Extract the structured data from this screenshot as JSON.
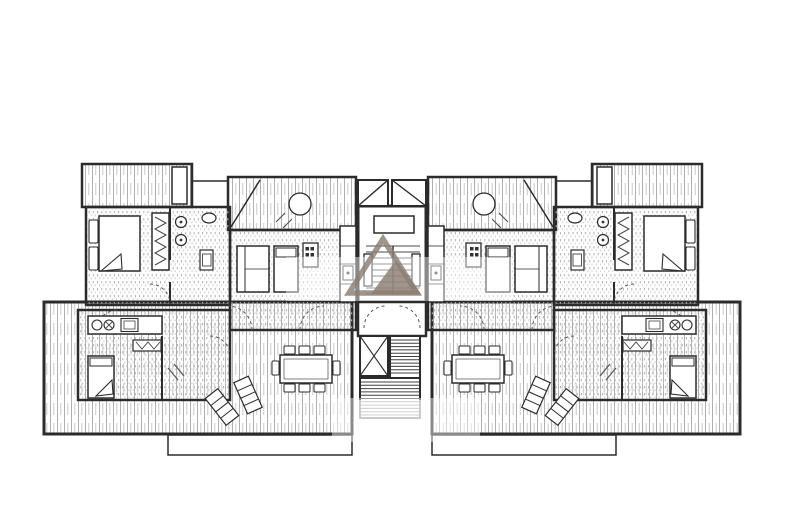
{
  "canvas": {
    "width": 800,
    "height": 531,
    "background": "#ffffff",
    "mirror_axis_x": 392
  },
  "palette": {
    "wall": "#2b2b2b",
    "furniture_stroke": "#3a3a3a",
    "hatch_dark": "#a6a6a6",
    "hatch_light": "#c4c4c4",
    "dot_dark": "#b0b0b0",
    "dot_light": "#c9c9c9",
    "tread": "#4a4a4a",
    "swing": "#555555",
    "watermark": "#8b7e73",
    "paper": "#ffffff"
  },
  "drawing": {
    "type": "architectural-floor-plan",
    "description": "Symmetric apartment floor plan: two mirrored wings around a central stair core with skylights, elevator shaft and descending stairs; terraces with furniture; gray triangle logo watermark"
  },
  "left_wing": [
    {
      "n": "terrace-lower",
      "t": "rect",
      "x": 44,
      "y": 302,
      "w": 308,
      "h": 132,
      "f": "v",
      "sw": 3
    },
    {
      "n": "terrace-lower-lip",
      "t": "rect",
      "x": 168,
      "y": 435,
      "w": 184,
      "h": 20,
      "f": "w",
      "sw": 1.5
    },
    {
      "n": "balcony-top",
      "t": "rect",
      "x": 82,
      "y": 164,
      "w": 110,
      "h": 43,
      "f": "v",
      "sw": 2.5
    },
    {
      "n": "balcony-planter",
      "t": "rect",
      "x": 172,
      "y": 167,
      "w": 15,
      "h": 37,
      "f": "w",
      "sw": 1.5
    },
    {
      "n": "parapet-link",
      "t": "line",
      "x1": 192,
      "y1": 181,
      "x2": 228,
      "y2": 181,
      "sw": 1.5
    },
    {
      "n": "terrace-mid",
      "t": "rect",
      "x": 228,
      "y": 177,
      "w": 128,
      "h": 53,
      "f": "v",
      "sw": 2.5
    },
    {
      "n": "terrace-mid-brace",
      "t": "line",
      "x1": 231,
      "y1": 227,
      "x2": 260,
      "y2": 180,
      "sw": 1.5
    },
    {
      "n": "terrace-round-table",
      "t": "circle",
      "cx": 300,
      "cy": 204,
      "r": 11,
      "f": "w",
      "sw": 1.3
    },
    {
      "n": "terrace-chair-mark",
      "t": "line",
      "x1": 276,
      "y1": 222,
      "x2": 285,
      "y2": 213,
      "sw": 1.2,
      "sc": "#555555"
    },
    {
      "n": "terrace-chair-mark",
      "t": "line",
      "x1": 283,
      "y1": 228,
      "x2": 292,
      "y2": 219,
      "sw": 1.2,
      "sc": "#555555"
    },
    {
      "n": "bedroom-upper",
      "t": "rect",
      "x": 86,
      "y": 207,
      "w": 144,
      "h": 98,
      "f": "d",
      "sw": 2.5
    },
    {
      "n": "living-upper",
      "t": "rect",
      "x": 230,
      "y": 230,
      "w": 126,
      "h": 100,
      "f": "d",
      "sw": 2.5
    },
    {
      "n": "suite-lower",
      "t": "rect",
      "x": 78,
      "y": 310,
      "w": 152,
      "h": 90,
      "f": "d",
      "sw": 2.5
    },
    {
      "n": "wall-bathroom",
      "t": "line",
      "x1": 170,
      "y1": 207,
      "x2": 170,
      "y2": 260,
      "sw": 2
    },
    {
      "n": "wall-bathroom",
      "t": "line",
      "x1": 170,
      "y1": 282,
      "x2": 170,
      "y2": 305,
      "sw": 2
    },
    {
      "n": "wall-suite-divider",
      "t": "line",
      "x1": 162,
      "y1": 336,
      "x2": 162,
      "y2": 400,
      "sw": 2
    },
    {
      "n": "wardrobe-upper",
      "t": "rect",
      "x": 152,
      "y": 213,
      "w": 17,
      "h": 57,
      "f": "w",
      "sw": 1.5
    },
    {
      "n": "wardrobe-rail",
      "t": "path",
      "d": "M155,217 L166,223 L155,229 L166,235 L155,241 L166,247 L155,253 L166,259 L155,265",
      "f": "none",
      "sw": 1,
      "sc": "#444444"
    },
    {
      "n": "bed-pillow",
      "t": "rect",
      "x": 89,
      "y": 220,
      "w": 9,
      "h": 23,
      "f": "w",
      "sw": 1.1,
      "rx": 1.5
    },
    {
      "n": "bed-pillow",
      "t": "rect",
      "x": 89,
      "y": 247,
      "w": 9,
      "h": 23,
      "f": "w",
      "sw": 1.1,
      "rx": 1.5
    },
    {
      "n": "bed-double",
      "t": "rect",
      "x": 99,
      "y": 216,
      "w": 41,
      "h": 55,
      "f": "w",
      "sw": 1.5
    },
    {
      "n": "bed-fold",
      "t": "poly",
      "p": "121,254 101,271 122,269",
      "f": "w",
      "sw": 1.1
    },
    {
      "n": "toilet",
      "t": "circle",
      "cx": 181,
      "cy": 222,
      "r": 5.5,
      "f": "w",
      "sw": 1.2
    },
    {
      "n": "toilet-dot",
      "t": "circle",
      "cx": 181,
      "cy": 222,
      "r": 1.4,
      "f": "#333333",
      "sw": 0
    },
    {
      "n": "bidet",
      "t": "circle",
      "cx": 181,
      "cy": 240,
      "r": 5.5,
      "f": "w",
      "sw": 1.2
    },
    {
      "n": "bidet-dot",
      "t": "circle",
      "cx": 181,
      "cy": 240,
      "r": 1.4,
      "f": "#333333",
      "sw": 0
    },
    {
      "n": "washbasin",
      "t": "ellipse",
      "cx": 209,
      "cy": 218,
      "rx": 7,
      "ry": 5,
      "f": "w",
      "sw": 1.2
    },
    {
      "n": "shower-tray",
      "t": "rect",
      "x": 200,
      "y": 250,
      "w": 13,
      "h": 20,
      "f": "w",
      "sw": 1.2
    },
    {
      "n": "shower-tray-inner",
      "t": "rect",
      "x": 202.5,
      "y": 254,
      "w": 8.5,
      "h": 12,
      "f": "none",
      "sw": 0.8
    },
    {
      "n": "door-swing",
      "t": "path",
      "d": "M150,284 A20,20 0 0 1 170,304",
      "f": "none",
      "da": "3,3",
      "sw": 1,
      "sc": "#555555"
    },
    {
      "n": "door-swing",
      "t": "path",
      "d": "M252,330 A24,24 0 0 0 228,306",
      "f": "none",
      "da": "3,3",
      "sw": 1,
      "sc": "#555555"
    },
    {
      "n": "door-swing",
      "t": "path",
      "d": "M300,330 A24,24 0 0 1 324,306",
      "f": "none",
      "da": "3,3",
      "sw": 1,
      "sc": "#555555"
    },
    {
      "n": "door-swing",
      "t": "path",
      "d": "M96,332 A22,22 0 0 1 118,310",
      "f": "none",
      "da": "3,3",
      "sw": 1,
      "sc": "#555555"
    },
    {
      "n": "door-swing",
      "t": "path",
      "d": "M210,336 A20,20 0 0 1 230,356",
      "f": "none",
      "da": "3,3",
      "sw": 1,
      "sc": "#555555"
    },
    {
      "n": "sofa",
      "t": "rect",
      "x": 237,
      "y": 246,
      "w": 32,
      "h": 46,
      "f": "w",
      "sw": 1.5
    },
    {
      "n": "sofa-back",
      "t": "line",
      "x1": 245,
      "y1": 246,
      "x2": 245,
      "y2": 292,
      "sw": 1
    },
    {
      "n": "sofa-cushion",
      "t": "line",
      "x1": 245,
      "y1": 269,
      "x2": 269,
      "y2": 269,
      "sw": 0.8
    },
    {
      "n": "daybed",
      "t": "rect",
      "x": 274,
      "y": 246,
      "w": 24,
      "h": 46,
      "f": "w",
      "sw": 1.5
    },
    {
      "n": "daybed-pillow",
      "t": "rect",
      "x": 276,
      "y": 248,
      "w": 20,
      "h": 9,
      "f": "w",
      "sw": 1
    },
    {
      "n": "kitchen-block",
      "t": "rect",
      "x": 303,
      "y": 243,
      "w": 15,
      "h": 24,
      "f": "w",
      "sw": 1.3
    },
    {
      "n": "burner",
      "t": "rect",
      "x": 305.5,
      "y": 247,
      "w": 3.5,
      "h": 3.5,
      "f": "#333333",
      "sw": 0
    },
    {
      "n": "burner",
      "t": "rect",
      "x": 310.5,
      "y": 247,
      "w": 3.5,
      "h": 3.5,
      "f": "#333333",
      "sw": 0
    },
    {
      "n": "burner",
      "t": "rect",
      "x": 305.5,
      "y": 253,
      "w": 3.5,
      "h": 3.5,
      "f": "#333333",
      "sw": 0
    },
    {
      "n": "burner",
      "t": "rect",
      "x": 310.5,
      "y": 253,
      "w": 3.5,
      "h": 3.5,
      "f": "#333333",
      "sw": 0
    },
    {
      "n": "kitchen-counter",
      "t": "rect",
      "x": 340,
      "y": 226,
      "w": 16,
      "h": 76,
      "f": "w",
      "sw": 1.5
    },
    {
      "n": "counter-divider",
      "t": "line",
      "x1": 340,
      "y1": 246,
      "x2": 356,
      "y2": 246,
      "sw": 0.8
    },
    {
      "n": "counter-divider",
      "t": "line",
      "x1": 340,
      "y1": 264,
      "x2": 356,
      "y2": 264,
      "sw": 0.8
    },
    {
      "n": "counter-divider",
      "t": "line",
      "x1": 340,
      "y1": 284,
      "x2": 356,
      "y2": 284,
      "sw": 0.8
    },
    {
      "n": "counter-appliance",
      "t": "rect",
      "x": 343,
      "y": 266,
      "w": 10,
      "h": 14,
      "f": "none",
      "sw": 1
    },
    {
      "n": "appliance-dot",
      "t": "circle",
      "cx": 348,
      "cy": 273,
      "r": 1.5,
      "f": "#333333",
      "sw": 0
    },
    {
      "n": "dining-table",
      "t": "rect",
      "x": 280,
      "y": 355,
      "w": 52,
      "h": 28,
      "f": "w",
      "sw": 1.5
    },
    {
      "n": "dining-table-inner",
      "t": "rect",
      "x": 284,
      "y": 359,
      "w": 44,
      "h": 20,
      "f": "none",
      "sw": 0.6
    },
    {
      "n": "dining-chair",
      "t": "rect",
      "x": 284,
      "y": 346,
      "w": 11,
      "h": 8,
      "f": "w",
      "sw": 1,
      "rx": 1
    },
    {
      "n": "dining-chair",
      "t": "rect",
      "x": 299,
      "y": 346,
      "w": 11,
      "h": 8,
      "f": "w",
      "sw": 1,
      "rx": 1
    },
    {
      "n": "dining-chair",
      "t": "rect",
      "x": 314,
      "y": 346,
      "w": 11,
      "h": 8,
      "f": "w",
      "sw": 1,
      "rx": 1
    },
    {
      "n": "dining-chair",
      "t": "rect",
      "x": 284,
      "y": 384,
      "w": 11,
      "h": 8,
      "f": "w",
      "sw": 1,
      "rx": 1
    },
    {
      "n": "dining-chair",
      "t": "rect",
      "x": 299,
      "y": 384,
      "w": 11,
      "h": 8,
      "f": "w",
      "sw": 1,
      "rx": 1
    },
    {
      "n": "dining-chair",
      "t": "rect",
      "x": 314,
      "y": 384,
      "w": 11,
      "h": 8,
      "f": "w",
      "sw": 1,
      "rx": 1
    },
    {
      "n": "dining-chair",
      "t": "rect",
      "x": 272,
      "y": 361,
      "w": 7,
      "h": 14,
      "f": "w",
      "sw": 1,
      "rx": 1
    },
    {
      "n": "dining-chair",
      "t": "rect",
      "x": 333,
      "y": 361,
      "w": 7,
      "h": 14,
      "f": "w",
      "sw": 1,
      "rx": 1
    },
    {
      "n": "lounge-chair",
      "t": "rect",
      "x": 214,
      "y": 390,
      "w": 16,
      "h": 34,
      "f": "w",
      "sw": 1.2,
      "tr": "rotate(-38 222 407)"
    },
    {
      "n": "lounge-stripe",
      "t": "line",
      "x1": 214,
      "y1": 399,
      "x2": 230,
      "y2": 399,
      "sw": 1,
      "tr": "rotate(-38 222 407)"
    },
    {
      "n": "lounge-stripe",
      "t": "line",
      "x1": 214,
      "y1": 407,
      "x2": 230,
      "y2": 407,
      "sw": 1,
      "tr": "rotate(-38 222 407)"
    },
    {
      "n": "lounge-stripe",
      "t": "line",
      "x1": 214,
      "y1": 415,
      "x2": 230,
      "y2": 415,
      "sw": 1,
      "tr": "rotate(-38 222 407)"
    },
    {
      "n": "lounge-chair",
      "t": "rect",
      "x": 240,
      "y": 378,
      "w": 16,
      "h": 34,
      "f": "w",
      "sw": 1.2,
      "tr": "rotate(-24 248 395)"
    },
    {
      "n": "lounge-stripe",
      "t": "line",
      "x1": 240,
      "y1": 387,
      "x2": 256,
      "y2": 387,
      "sw": 1,
      "tr": "rotate(-24 248 395)"
    },
    {
      "n": "lounge-stripe",
      "t": "line",
      "x1": 240,
      "y1": 395,
      "x2": 256,
      "y2": 395,
      "sw": 1,
      "tr": "rotate(-24 248 395)"
    },
    {
      "n": "lounge-stripe",
      "t": "line",
      "x1": 240,
      "y1": 403,
      "x2": 256,
      "y2": 403,
      "sw": 1,
      "tr": "rotate(-24 248 395)"
    },
    {
      "n": "kitchenette-lower",
      "t": "rect",
      "x": 88,
      "y": 316,
      "w": 74,
      "h": 18,
      "f": "w",
      "sw": 1.5
    },
    {
      "n": "sink-round",
      "t": "circle",
      "cx": 97,
      "cy": 325,
      "r": 5,
      "f": "w",
      "sw": 1.1
    },
    {
      "n": "hob-round",
      "t": "circle",
      "cx": 109,
      "cy": 325,
      "r": 5,
      "f": "w",
      "sw": 1.1
    },
    {
      "n": "hob-cross",
      "t": "line",
      "x1": 106,
      "y1": 322,
      "x2": 112,
      "y2": 328,
      "sw": 0.9,
      "sc": "#444444"
    },
    {
      "n": "hob-cross",
      "t": "line",
      "x1": 112,
      "y1": 322,
      "x2": 106,
      "y2": 328,
      "sw": 0.9,
      "sc": "#444444"
    },
    {
      "n": "stove-lower",
      "t": "rect",
      "x": 121,
      "y": 318.5,
      "w": 17,
      "h": 13,
      "f": "w",
      "sw": 1.1
    },
    {
      "n": "stove-inner",
      "t": "rect",
      "x": 124,
      "y": 321,
      "w": 11,
      "h": 8,
      "f": "none",
      "sw": 0.7
    },
    {
      "n": "wardrobe-lower",
      "t": "rect",
      "x": 133,
      "y": 340,
      "w": 28,
      "h": 11,
      "f": "w",
      "sw": 1.2
    },
    {
      "n": "wardrobe-rail",
      "t": "path",
      "d": "M136,342 L142,349 L148,342 L154,349 L160,342",
      "f": "none",
      "sw": 0.9,
      "sc": "#444444"
    },
    {
      "n": "bed-single",
      "t": "rect",
      "x": 88,
      "y": 356,
      "w": 26,
      "h": 42,
      "f": "w",
      "sw": 1.5
    },
    {
      "n": "bed-pillow",
      "t": "rect",
      "x": 90,
      "y": 358,
      "w": 22,
      "h": 8,
      "f": "w",
      "sw": 1
    },
    {
      "n": "bed-fold",
      "t": "poly",
      "p": "112,380 96,396 113,394",
      "f": "w",
      "sw": 1.1
    },
    {
      "n": "chair-mark",
      "t": "line",
      "x1": 168,
      "y1": 368,
      "x2": 178,
      "y2": 380,
      "sw": 1.2,
      "sc": "#555555"
    },
    {
      "n": "chair-mark",
      "t": "line",
      "x1": 174,
      "y1": 364,
      "x2": 184,
      "y2": 376,
      "sw": 1.2,
      "sc": "#555555"
    }
  ],
  "center_core": [
    {
      "n": "stair-core",
      "t": "rect",
      "x": 358,
      "y": 206,
      "w": 68,
      "h": 96,
      "f": "w",
      "sw": 3
    },
    {
      "n": "skylight",
      "t": "rect",
      "x": 358,
      "y": 180,
      "w": 30,
      "h": 26,
      "f": "w",
      "sw": 2
    },
    {
      "n": "skylight-diagonal",
      "t": "line",
      "x1": 358,
      "y1": 206,
      "x2": 388,
      "y2": 180,
      "sw": 1.4
    },
    {
      "n": "skylight",
      "t": "rect",
      "x": 392,
      "y": 180,
      "w": 34,
      "h": 26,
      "f": "w",
      "sw": 2
    },
    {
      "n": "skylight-diagonal",
      "t": "line",
      "x1": 392,
      "y1": 180,
      "x2": 426,
      "y2": 206,
      "sw": 1.4
    },
    {
      "n": "stair-landing",
      "t": "rect",
      "x": 374,
      "y": 216,
      "w": 40,
      "h": 17,
      "f": "none",
      "sw": 1.5
    },
    {
      "n": "stair-treads",
      "t": "hlines",
      "x": 366,
      "w": 54,
      "y0": 246,
      "dy": 6,
      "cnt": 9,
      "sw": 1.1,
      "sc": "#4a4a4a"
    },
    {
      "n": "stair-divider",
      "t": "line",
      "x1": 393,
      "y1": 246,
      "x2": 393,
      "y2": 295,
      "sw": 1.4
    },
    {
      "n": "stair-rail",
      "t": "rect",
      "x": 364,
      "y": 254,
      "w": 8,
      "h": 32,
      "f": "w",
      "sw": 1.3
    },
    {
      "n": "stair-rail",
      "t": "rect",
      "x": 412,
      "y": 254,
      "w": 8,
      "h": 32,
      "f": "w",
      "sw": 1.3
    },
    {
      "n": "stair-lobby",
      "t": "rect",
      "x": 358,
      "y": 302,
      "w": 68,
      "h": 34,
      "f": "w",
      "sw": 2.5
    },
    {
      "n": "door-swing",
      "t": "path",
      "d": "M364,328 A22,22 0 0 1 386,306",
      "f": "none",
      "da": "3,3",
      "sw": 1,
      "sc": "#555555"
    },
    {
      "n": "door-swing",
      "t": "path",
      "d": "M420,328 A22,22 0 0 0 398,306",
      "f": "none",
      "da": "3,3",
      "sw": 1,
      "sc": "#555555"
    },
    {
      "n": "elevator-shaft",
      "t": "rect",
      "x": 360,
      "y": 336,
      "w": 28,
      "h": 40,
      "f": "w",
      "sw": 2
    },
    {
      "n": "elevator-x",
      "t": "line",
      "x1": 360,
      "y1": 336,
      "x2": 388,
      "y2": 376,
      "sw": 1.1
    },
    {
      "n": "elevator-x",
      "t": "line",
      "x1": 388,
      "y1": 336,
      "x2": 360,
      "y2": 376,
      "sw": 1.1
    },
    {
      "n": "stair-down-upper",
      "t": "rect",
      "x": 390,
      "y": 336,
      "w": 30,
      "h": 42,
      "f": "w",
      "sw": 2
    },
    {
      "n": "stair-down-treads",
      "t": "hlines",
      "x": 391,
      "w": 28,
      "y0": 340,
      "dy": 3.3,
      "cnt": 11,
      "sw": 1,
      "sc": "#3f3f3f"
    },
    {
      "n": "stair-down-lower",
      "t": "rect",
      "x": 360,
      "y": 378,
      "w": 60,
      "h": 40,
      "f": "w",
      "sw": 2
    },
    {
      "n": "stair-down-treads",
      "t": "hlines",
      "x": 361,
      "w": 58,
      "y0": 382,
      "dy": 3.3,
      "cnt": 11,
      "sw": 1,
      "sc": "#3f3f3f"
    },
    {
      "n": "print-fade",
      "t": "rect",
      "x": 356,
      "y": 400,
      "w": 68,
      "h": 24,
      "f": "#ffffff",
      "sw": 0,
      "op": 0.55
    },
    {
      "n": "watermark-band",
      "t": "rect",
      "x": 286,
      "y": 257,
      "w": 226,
      "h": 44,
      "f": "#ffffff",
      "sw": 0,
      "op": 0.45
    },
    {
      "n": "watermark-band",
      "t": "rect",
      "x": 332,
      "y": 398,
      "w": 148,
      "h": 44,
      "f": "#ffffff",
      "sw": 0,
      "op": 0.45
    },
    {
      "n": "watermark-triangle-outline",
      "t": "path",
      "d": "M383,239 L417,293 L349,293 Z",
      "f": "none",
      "sw": 5.5,
      "sc": "#8b7e73",
      "op": 0.82
    },
    {
      "n": "watermark-triangle-solid",
      "t": "path",
      "d": "M396,260 L421,294 L371,294 Z",
      "f": "#8b7e73",
      "sw": 0,
      "op": 0.82
    }
  ]
}
